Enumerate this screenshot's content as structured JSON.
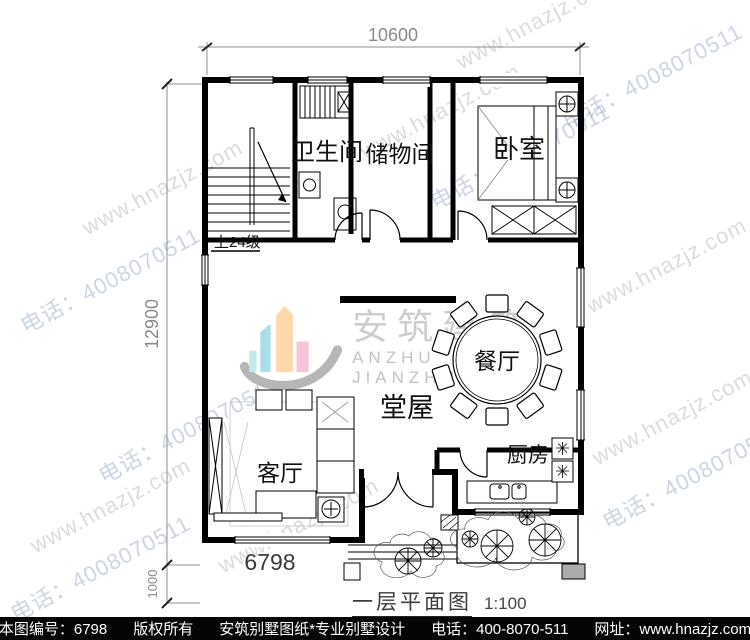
{
  "watermark": {
    "site": "www.hnazjz.com",
    "phone": "电话：4008070511"
  },
  "dimensions": {
    "top": "10600",
    "left": "12900",
    "left_small": "1000",
    "bottom": "6798"
  },
  "rooms": {
    "bathroom": "卫生间",
    "storage": "储物间",
    "bedroom": "卧室",
    "dining": "餐厅",
    "hall": "堂屋",
    "living": "客厅",
    "kitchen": "厨房"
  },
  "stairs": {
    "note": "上24级"
  },
  "logo": {
    "cn": "安筑建筑",
    "en": "ANZHU JIANZHU"
  },
  "title": {
    "name": "一层平面图",
    "scale": "1:100"
  },
  "footer": {
    "no": "本图编号：6798",
    "copyright": "版权所有",
    "brand": "安筑别墅图纸*专业别墅设计",
    "phone": "电话：400-8070-511",
    "site": "网址：www.hnazjz.com"
  },
  "colors": {
    "logo_teal": "#a9dee8",
    "logo_teal_light": "#c2e9ee",
    "logo_peach": "#ffd8a9",
    "logo_pink": "#f6c3d9",
    "logo_swoosh": "#b6b6b6",
    "footer_bg": "#050505",
    "dim_text": "#8a8a8a",
    "watermark_gray": "#b0b0b0",
    "watermark_blue": "#94a8c4"
  }
}
